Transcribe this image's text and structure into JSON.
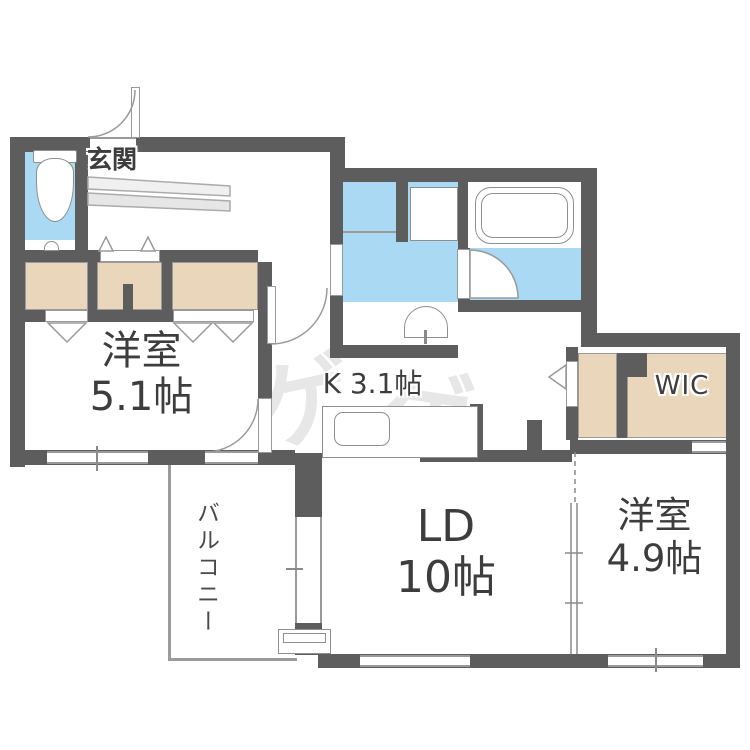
{
  "plan_title": "apartment-floorplan",
  "rooms": {
    "entrance": {
      "label": "玄関"
    },
    "bedroom1": {
      "name": "洋室",
      "size": "5.1帖"
    },
    "kitchen": {
      "label": "K 3.1帖"
    },
    "living": {
      "name": "LD",
      "size": "10帖"
    },
    "bedroom2": {
      "name": "洋室",
      "size": "4.9帖"
    },
    "wic": {
      "label": "WIC"
    },
    "balcony": {
      "label": "バルコニー"
    }
  },
  "watermark": {
    "char1": "ゲ",
    "char2": "ゲ"
  },
  "colors": {
    "wall": "#5d5d5d",
    "water_area": "#a9d9f3",
    "closet": "#e9d6bb",
    "line": "#9a9a9a",
    "text": "#3d3d3d"
  }
}
